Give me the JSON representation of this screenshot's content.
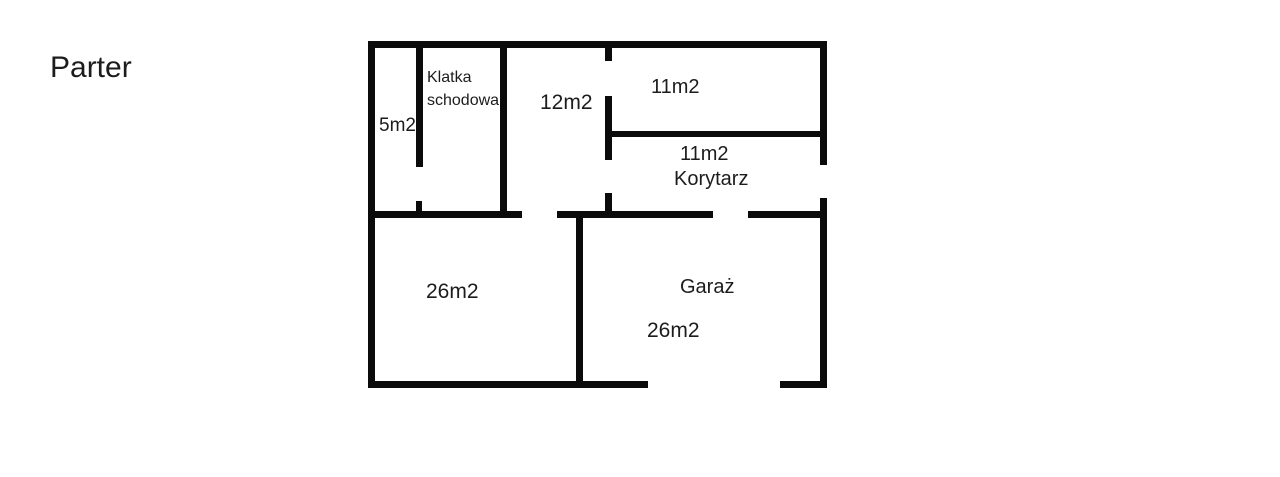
{
  "page": {
    "title": "Parter",
    "background": "#ffffff",
    "wall_color": "#0b0b0b",
    "text_color": "#1c1c1c"
  },
  "floorplan": {
    "rooms": {
      "staircase": {
        "name_line1": "Klatka",
        "name_line2": "schodowa"
      },
      "small_room": {
        "area": "5m2"
      },
      "room_12": {
        "area": "12m2"
      },
      "room_11": {
        "area": "11m2"
      },
      "corridor": {
        "area": "11m2",
        "name": "Korytarz"
      },
      "room_26": {
        "area": "26m2"
      },
      "garage": {
        "name": "Garaż",
        "area": "26m2"
      }
    }
  }
}
